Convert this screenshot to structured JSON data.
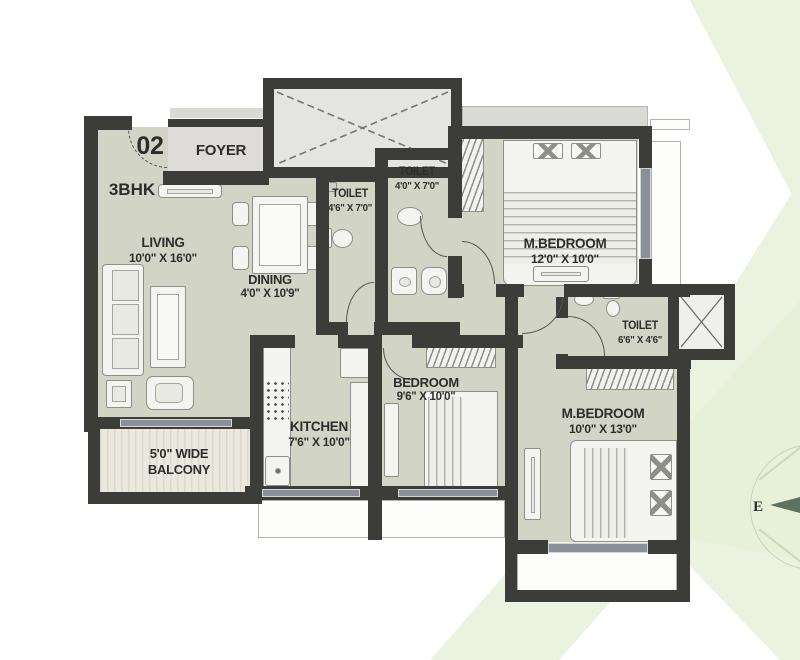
{
  "plan": {
    "unit_number": "02",
    "unit_type": "3BHK",
    "foyer": "FOYER",
    "rooms": {
      "living": {
        "name": "LIVING",
        "dims": "10'0\" X 16'0\""
      },
      "dining": {
        "name": "DINING",
        "dims": "4'0\" X 10'9\""
      },
      "toilet1": {
        "name": "TOILET",
        "dims": "4'6\" X 7'0\""
      },
      "toilet2": {
        "name": "TOILET",
        "dims": "4'0\" X 7'0\""
      },
      "mbedroom1": {
        "name": "M.BEDROOM",
        "dims": "12'0\" X 10'0\""
      },
      "toilet3": {
        "name": "TOILET",
        "dims": "6'6\" X 4'6\""
      },
      "bedroom": {
        "name": "BEDROOM",
        "dims": "9'6\" X 10'0\""
      },
      "kitchen": {
        "name": "KITCHEN",
        "dims": "7'6\" X 10'0\""
      },
      "mbedroom2": {
        "name": "M.BEDROOM",
        "dims": "10'0\" X 13'0\""
      }
    },
    "balcony": {
      "line1": "5'0\" WIDE",
      "line2": "BALCONY"
    },
    "compass": {
      "east": "E"
    }
  },
  "colors": {
    "wall": "#3c3c38",
    "floor": "#d2d5c6",
    "corridor": "#d9d9d5",
    "window": "#8a8f99",
    "accent_green": "#ecf2e0",
    "compass_needle": "#5d715e"
  }
}
